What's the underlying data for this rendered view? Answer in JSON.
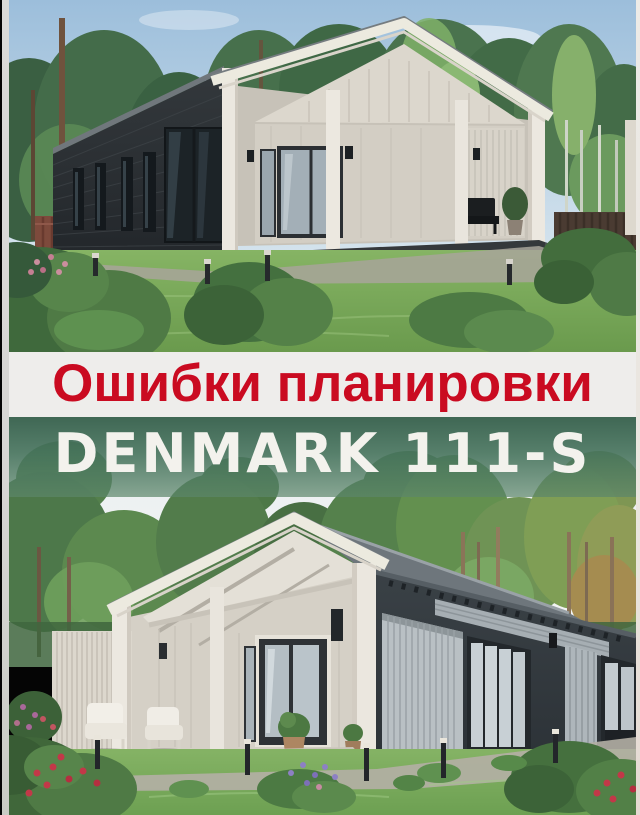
{
  "overlay": {
    "title": {
      "text": "Ошибки планировки"
    },
    "model": {
      "text": "DENMARK 111-S"
    }
  },
  "colors": {
    "title_color": "#ca0b21",
    "title_band_bg": "#eeedeb",
    "model_color": "#f3f2ed",
    "model_band_bg": "#4a745d",
    "frame_edge": "#d6d5d3",
    "top_sky": "#9cbedb",
    "top_house_wall": "#2b3034",
    "porch_wood": "#ebe7df",
    "bottom_sky": "#e9eef1",
    "bottom_house_wall": "#373e43",
    "lawn": "#7fae62"
  },
  "photos": {
    "top": {
      "label": "dark charcoal barnhouse with white gabled porch among pine forest"
    },
    "bottom": {
      "label": "white gabled porch barnhouse with dark wing among pine forest"
    }
  }
}
